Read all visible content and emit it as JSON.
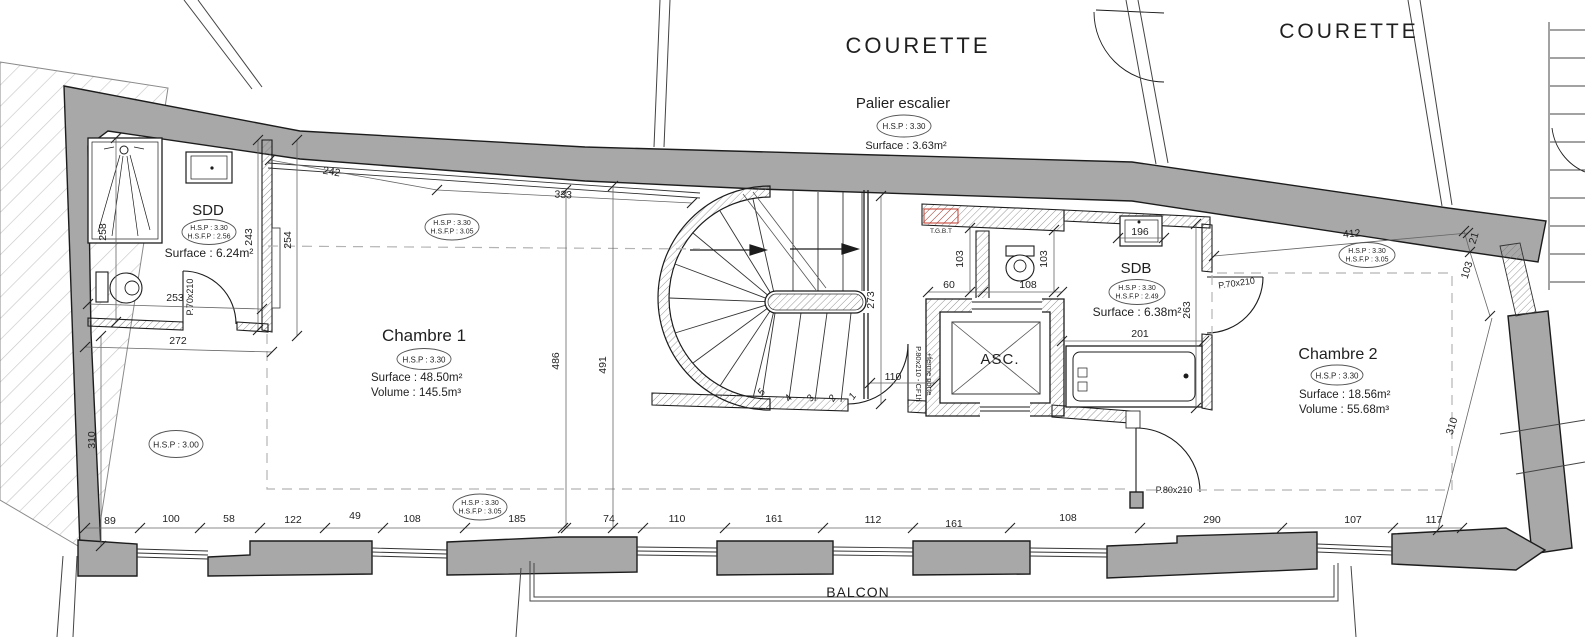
{
  "plan_labels": {
    "courette_left": "COURETTE",
    "courette_right": "COURETTE",
    "balcon": "BALCON",
    "tgbt": "T.G.B.T"
  },
  "rooms": {
    "palier": {
      "name": "Palier escalier",
      "hsp": "H.S.P : 3.30",
      "surface": "Surface : 3.63m²"
    },
    "sdd": {
      "name": "SDD",
      "hsp": "H.S.P : 3.30",
      "hsfp": "H.S.F.P : 2.56",
      "surface": "Surface : 6.24m²"
    },
    "chambre1": {
      "name": "Chambre 1",
      "hsp": "H.S.P : 3.30",
      "surface": "Surface : 48.50m²",
      "volume": "Volume : 145.5m³"
    },
    "sdb": {
      "name": "SDB",
      "hsp": "H.S.P : 3.30",
      "hsfp": "H.S.F.P : 2.49",
      "surface": "Surface : 6.38m²"
    },
    "chambre2": {
      "name": "Chambre 2",
      "hsp": "H.S.P : 3.30",
      "surface": "Surface : 18.56m²",
      "volume": "Volume : 55.68m³"
    },
    "ascenseur": {
      "name": "ASC."
    }
  },
  "height_bubbles": {
    "facade_nord": {
      "l1": "H.S.P : 3.30",
      "l2": "H.S.F.P : 3.05"
    },
    "facade_sud": {
      "l1": "H.S.P : 3.30",
      "l2": "H.S.F.P : 3.05"
    },
    "chambre2_nord": {
      "l1": "H.S.P : 3.30",
      "l2": "H.S.F.P : 3.05"
    },
    "chambre1_ouest": {
      "l1": "H.S.P : 3.00"
    }
  },
  "colors": {
    "wall_gray": "#a8a8a8",
    "line": "#1c1c1c",
    "accent_red": "#c0392b"
  },
  "annotations": [
    {
      "t": "89",
      "x": 110,
      "y": 524
    },
    {
      "t": "100",
      "x": 171,
      "y": 522
    },
    {
      "t": "58",
      "x": 229,
      "y": 522
    },
    {
      "t": "122",
      "x": 293,
      "y": 523
    },
    {
      "t": "49",
      "x": 355,
      "y": 519
    },
    {
      "t": "108",
      "x": 412,
      "y": 522
    },
    {
      "t": "185",
      "x": 517,
      "y": 522
    },
    {
      "t": "74",
      "x": 609,
      "y": 522
    },
    {
      "t": "110",
      "x": 677,
      "y": 522
    },
    {
      "t": "161",
      "x": 774,
      "y": 522
    },
    {
      "t": "112",
      "x": 873,
      "y": 523
    },
    {
      "t": "161",
      "x": 954,
      "y": 527
    },
    {
      "t": "108",
      "x": 1068,
      "y": 521
    },
    {
      "t": "290",
      "x": 1212,
      "y": 523
    },
    {
      "t": "107",
      "x": 1353,
      "y": 523
    },
    {
      "t": "117",
      "x": 1434,
      "y": 523
    },
    {
      "t": "242",
      "x": 331,
      "y": 175,
      "r": 10
    },
    {
      "t": "333",
      "x": 563,
      "y": 198,
      "r": 3
    },
    {
      "t": "412",
      "x": 1352,
      "y": 237,
      "r": -5
    },
    {
      "t": "21",
      "x": 1477,
      "y": 239,
      "r": -73
    },
    {
      "t": "103",
      "x": 1470,
      "y": 271,
      "r": -73
    },
    {
      "t": "310",
      "x": 1455,
      "y": 427,
      "r": -73
    },
    {
      "t": "258",
      "x": 106,
      "y": 232,
      "r": -90
    },
    {
      "t": "243",
      "x": 252,
      "y": 237,
      "r": -90
    },
    {
      "t": "254",
      "x": 291,
      "y": 240,
      "r": -90
    },
    {
      "t": "310",
      "x": 95,
      "y": 440,
      "r": -90
    },
    {
      "t": "253",
      "x": 175,
      "y": 301
    },
    {
      "t": "272",
      "x": 178,
      "y": 344
    },
    {
      "t": "486",
      "x": 559,
      "y": 361,
      "r": -90
    },
    {
      "t": "491",
      "x": 606,
      "y": 365,
      "r": -90
    },
    {
      "t": "273",
      "x": 874,
      "y": 300,
      "r": -90
    },
    {
      "t": "103",
      "x": 963,
      "y": 259,
      "r": -90
    },
    {
      "t": "103",
      "x": 1047,
      "y": 259,
      "r": -90
    },
    {
      "t": "60",
      "x": 949,
      "y": 288
    },
    {
      "t": "108",
      "x": 1028,
      "y": 288
    },
    {
      "t": "196",
      "x": 1140,
      "y": 235
    },
    {
      "t": "263",
      "x": 1190,
      "y": 310,
      "r": -90
    },
    {
      "t": "201",
      "x": 1140,
      "y": 337
    },
    {
      "t": "110",
      "x": 893,
      "y": 380
    },
    {
      "t": "P.70x210",
      "x": 193,
      "y": 297,
      "r": -90,
      "s": 9
    },
    {
      "t": "P.70x210",
      "x": 1237,
      "y": 286,
      "r": -8,
      "s": 9
    },
    {
      "t": "P.80x210",
      "x": 1174,
      "y": 493,
      "s": 9
    },
    {
      "t": "P.80x210 - CF1h",
      "x": 916,
      "y": 374,
      "r": 90,
      "s": 7.5
    },
    {
      "t": "+ferme porte",
      "x": 927,
      "y": 374,
      "r": 90,
      "s": 7.5
    },
    {
      "t": "5",
      "x": 764,
      "y": 394,
      "r": -55,
      "s": 10,
      "i": 1
    },
    {
      "t": "4",
      "x": 791,
      "y": 400,
      "r": -55,
      "s": 10,
      "i": 1
    },
    {
      "t": "3",
      "x": 813,
      "y": 400,
      "r": -55,
      "s": 10,
      "i": 1
    },
    {
      "t": "2",
      "x": 835,
      "y": 400,
      "r": -55,
      "s": 10,
      "i": 1
    },
    {
      "t": "1",
      "x": 855,
      "y": 398,
      "r": -55,
      "s": 10,
      "i": 1
    },
    {
      "t": "T.G.B.T",
      "x": 941,
      "y": 233,
      "s": 6.5,
      "c": "#c0392b"
    }
  ]
}
